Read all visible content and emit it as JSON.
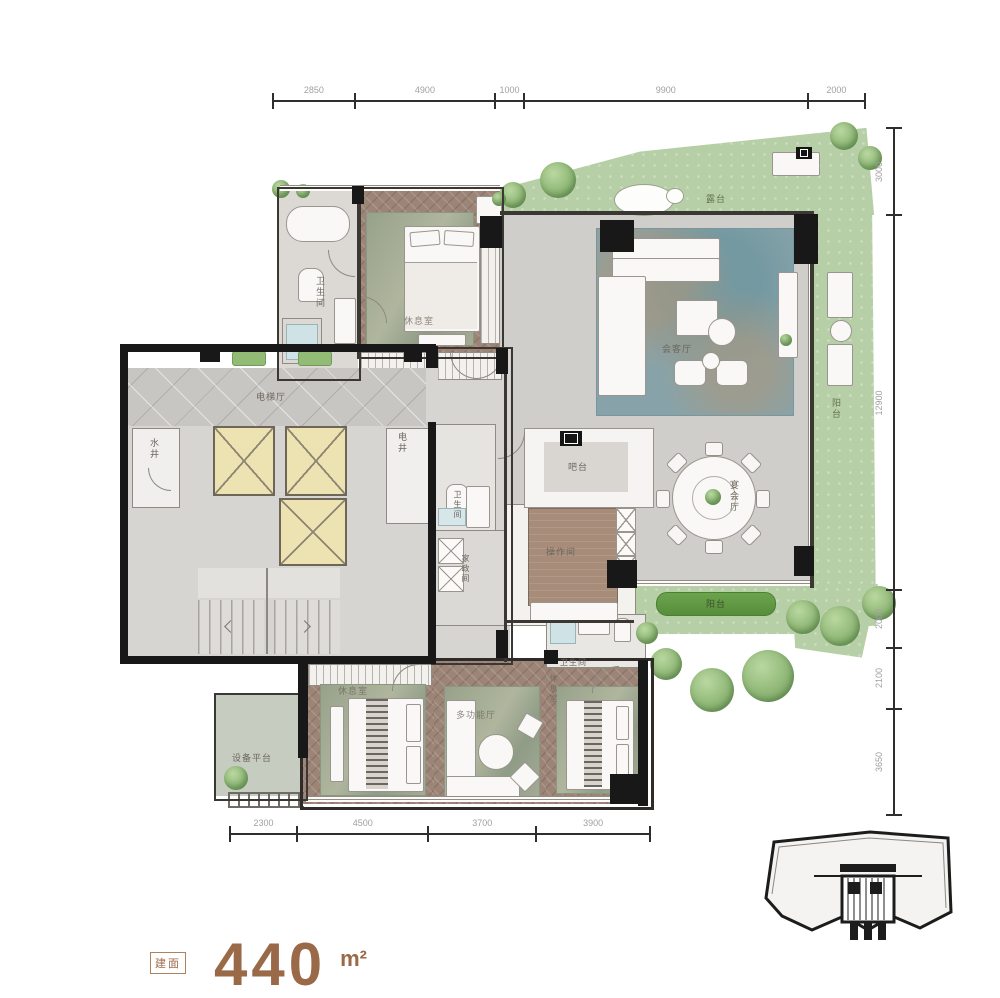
{
  "dimensions": {
    "top": [
      "2850",
      "4900",
      "1000",
      "9900",
      "2000"
    ],
    "right": [
      "3000",
      "12900",
      "2000",
      "2100",
      "3650"
    ],
    "bottom": [
      "2300",
      "4500",
      "3700",
      "3900"
    ]
  },
  "rooms": {
    "elevator_hall": "电梯厅",
    "water_shaft": "水井",
    "electric_shaft": "电井",
    "suite1_bath": "卫生间",
    "suite1": "休息室",
    "hall_bath": "卫生间",
    "housekeeping": "家政间",
    "kitchen": "操作间",
    "bar": "吧台",
    "banquet": "宴会厅",
    "reception": "会客厅",
    "roof_terrace": "露台",
    "balcony_right": "阳台",
    "balcony_bottom": "阳台",
    "equipment": "设备平台",
    "suite2": "休息室",
    "multi_hall": "多功能厅",
    "suite3": "休息室",
    "suite3_bath": "卫生间"
  },
  "area": {
    "badge": "建面",
    "value": "440",
    "unit": "m²"
  },
  "colors": {
    "wood": "#9c8577",
    "terrace_green": "#b6cfa6",
    "shaft_yellow": "#ece2b2",
    "accent_brown": "#9a6a48",
    "wall_black": "#181818"
  }
}
